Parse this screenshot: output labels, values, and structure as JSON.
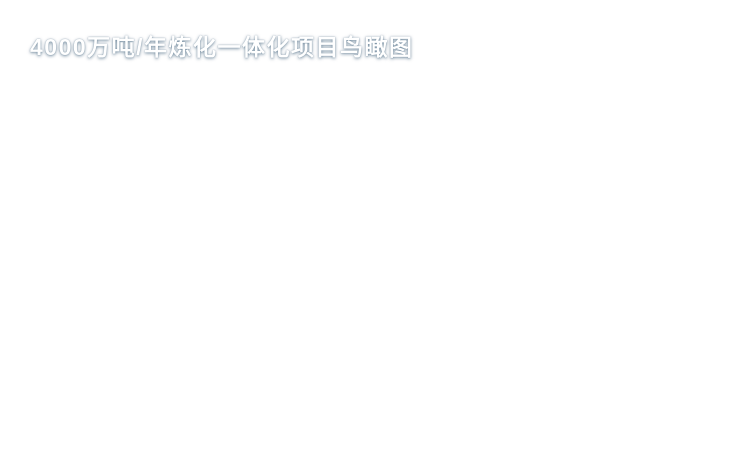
{
  "title": {
    "text": "4000万吨/年炼化一体化项目鸟瞰图"
  },
  "palette": {
    "water_deep": "#2f9fce",
    "water_main": "#3fb5de",
    "water_light": "#82ddeb",
    "sand": "#ecdf9f",
    "grass": "#74984a",
    "grass_dark": "#578038",
    "tree_dark": "#24401f",
    "tree_mid": "#33562a",
    "tree_light": "#446f36",
    "road_dark": "#45493f",
    "road_light": "#b6bfb4",
    "block_base": "#c7cdc8",
    "block_dark": "#5f6b72",
    "block_mid": "#99a3a7",
    "block_white": "#eef0ee",
    "tank_gray": "#d3d8d4",
    "pool_blue": "#3e8fc4",
    "pond": "#5fd2de",
    "pier": "#cdc5ac",
    "quay_white": "#ecf1ee",
    "ship_dark": "#4d565c",
    "cargo_red": "#a8392e",
    "title_color": "#ffffff"
  }
}
